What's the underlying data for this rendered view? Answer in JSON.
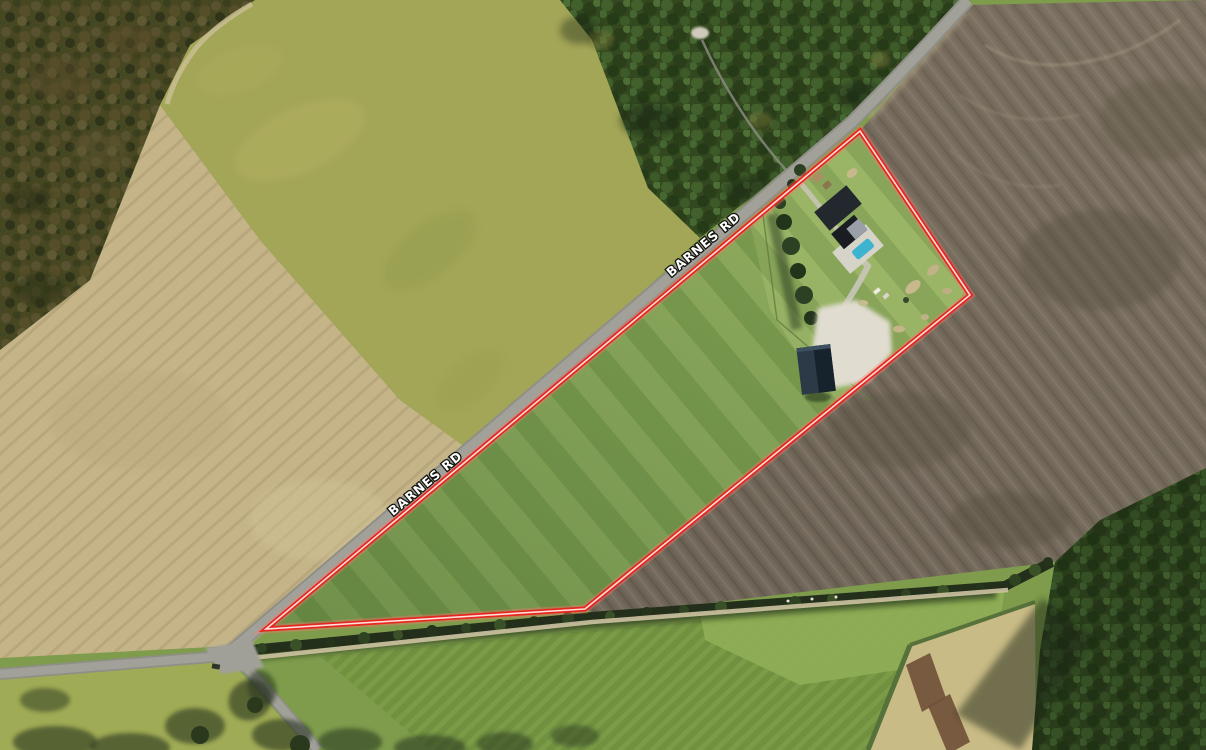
{
  "view": {
    "type": "aerial-satellite-photo",
    "description": "Overhead satellite view of farmland along Barnes Rd with a wedge-shaped property parcel outlined in red, containing a house with a swimming pool, a barn and a large grass pasture"
  },
  "labels": {
    "road_upper": "BARNES RD",
    "road_lower": "BARNES RD"
  },
  "parcel": {
    "outline_color": "#e8251f",
    "outline_core_color": "#ffe0da"
  },
  "palette": {
    "road": "#a1a199",
    "pool": "#3eb3cf",
    "pasture": "#84a355",
    "plowed_field": "#6c6255",
    "tan_field": "#c4b488",
    "forest": "#33481f"
  }
}
